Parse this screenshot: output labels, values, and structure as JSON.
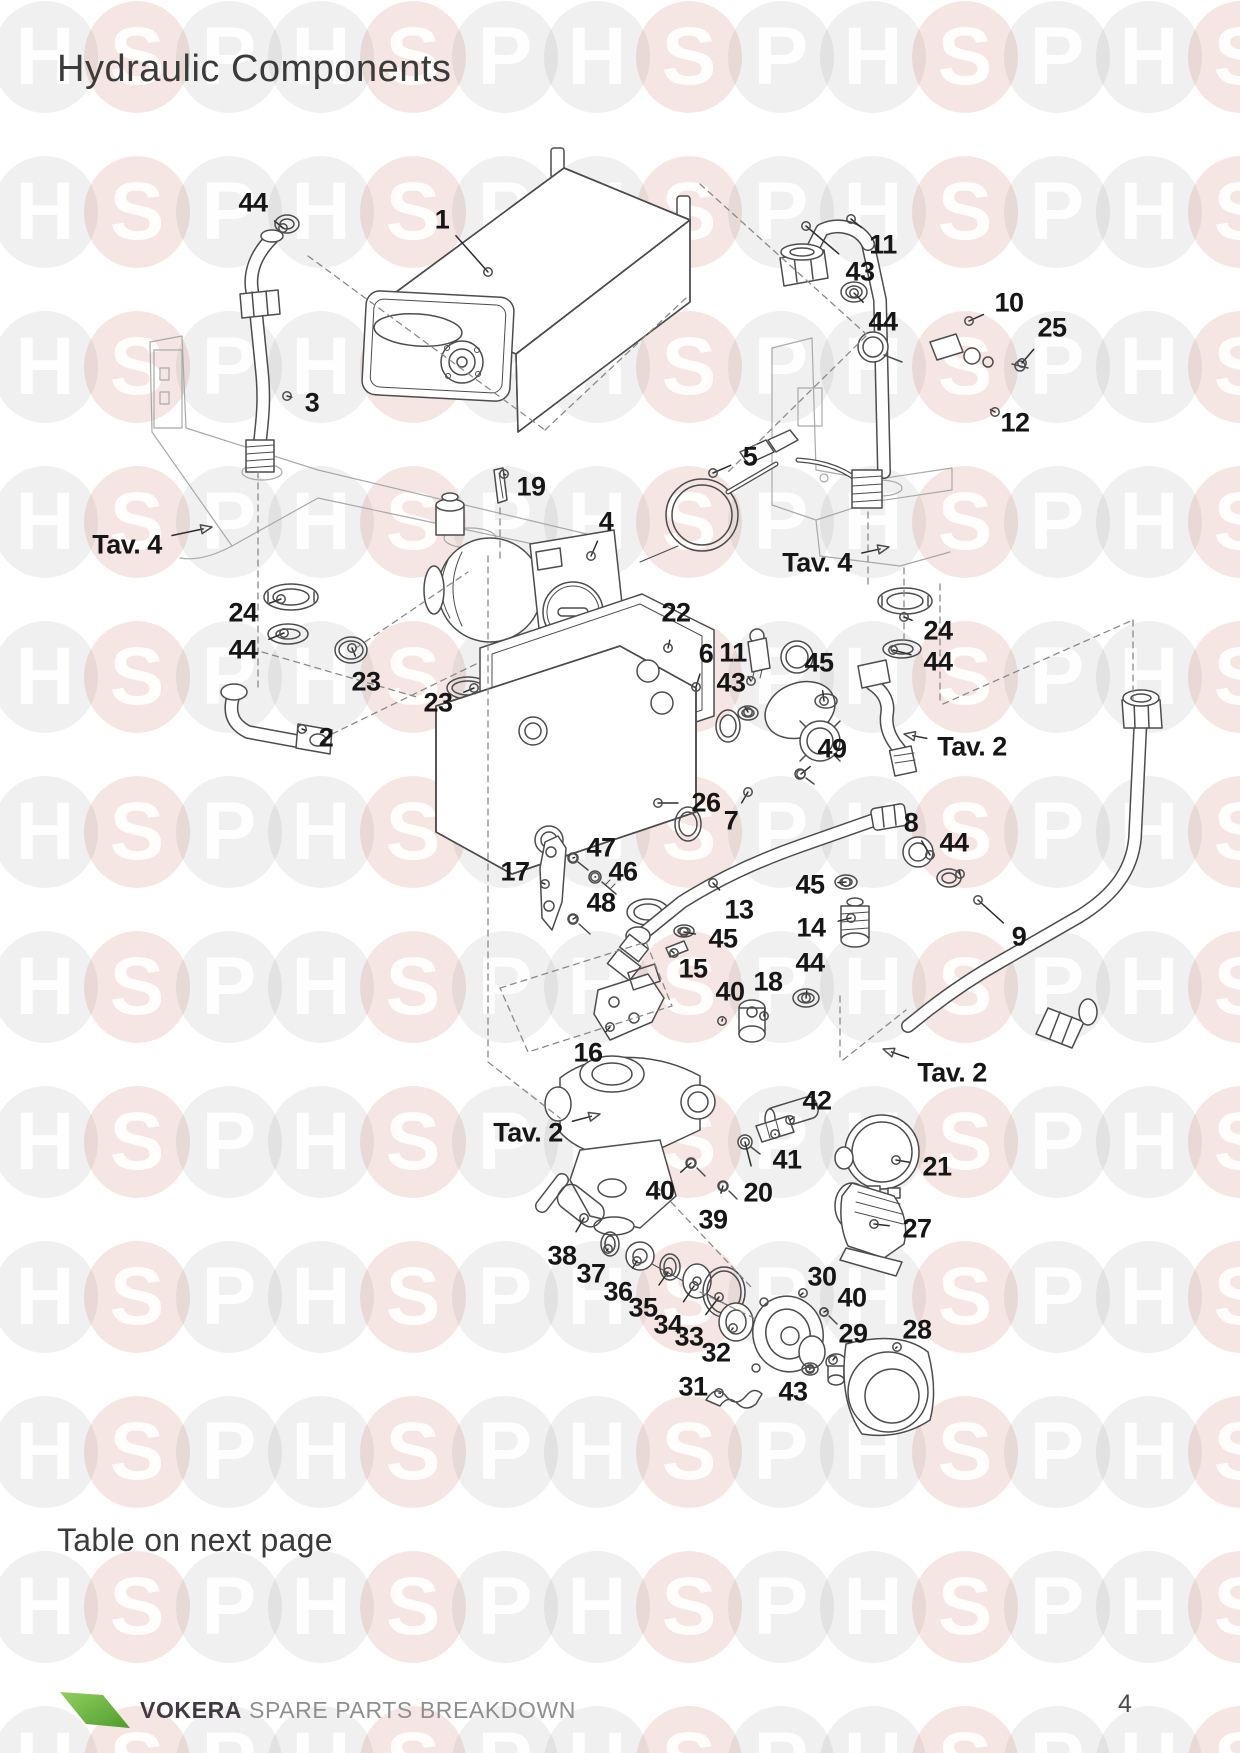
{
  "page": {
    "title": "Hydraulic Components",
    "note": "Table on next page",
    "page_number": "4",
    "footer": {
      "brand": "VOKERA",
      "tagline": "SPARE PARTS BREAKDOWN"
    }
  },
  "watermark": {
    "letters": [
      "H",
      "S",
      "P"
    ],
    "pink_rgba": "rgba(185,62,42,0.13)",
    "gray_rgba": "rgba(60,60,60,0.08)",
    "letter_color": "rgba(255,255,255,0.93)",
    "cols": 14,
    "rows": 12,
    "x0": 45,
    "y0": 57,
    "dx": 92,
    "dy": 155
  },
  "colors": {
    "ink": "#161616",
    "line": "#4c4c4c",
    "faint": "#a9a9a9",
    "logo_green": "#72bf44",
    "text": "#3b3b3b",
    "muted": "#8f8f92"
  },
  "diagram": {
    "callouts": [
      {
        "label": "44",
        "x": 253,
        "y": 203,
        "tx": 283,
        "ty": 228
      },
      {
        "label": "1",
        "x": 442,
        "y": 220,
        "tx": 488,
        "ty": 272
      },
      {
        "label": "3",
        "x": 312,
        "y": 403,
        "tx": 287,
        "ty": 396
      },
      {
        "label": "19",
        "x": 531,
        "y": 487,
        "tx": 504,
        "ty": 474
      },
      {
        "label": "4",
        "x": 606,
        "y": 522,
        "tx": 591,
        "ty": 556
      },
      {
        "label": "Tav. 4",
        "x": 127,
        "y": 545,
        "tx": 212,
        "ty": 527,
        "kind": "ref"
      },
      {
        "label": "24",
        "x": 243,
        "y": 613,
        "tx": 281,
        "ty": 599
      },
      {
        "label": "44",
        "x": 243,
        "y": 650,
        "tx": 284,
        "ty": 633
      },
      {
        "label": "23",
        "x": 366,
        "y": 682,
        "tx": 352,
        "ty": 648
      },
      {
        "label": "23",
        "x": 438,
        "y": 703,
        "tx": 474,
        "ty": 688
      },
      {
        "label": "2",
        "x": 326,
        "y": 738,
        "tx": 302,
        "ty": 729
      },
      {
        "label": "11",
        "x": 883,
        "y": 245,
        "tx": 851,
        "ty": 219
      },
      {
        "label": "43",
        "x": 860,
        "y": 272,
        "tx": 806,
        "ty": 226
      },
      {
        "label": "44",
        "x": 883,
        "y": 322,
        "tx": 854,
        "ty": 293
      },
      {
        "label": "10",
        "x": 1009,
        "y": 303,
        "tx": 969,
        "ty": 321
      },
      {
        "label": "25",
        "x": 1052,
        "y": 328,
        "tx": 1022,
        "ty": 363
      },
      {
        "label": "12",
        "x": 1015,
        "y": 423,
        "tx": 995,
        "ty": 412
      },
      {
        "label": "5",
        "x": 750,
        "y": 457,
        "tx": 713,
        "ty": 473
      },
      {
        "label": "Tav. 4",
        "x": 817,
        "y": 563,
        "tx": 889,
        "ty": 547,
        "kind": "ref"
      },
      {
        "label": "22",
        "x": 676,
        "y": 613,
        "tx": 668,
        "ty": 648
      },
      {
        "label": "6",
        "x": 706,
        "y": 654,
        "tx": 696,
        "ty": 687
      },
      {
        "label": "11",
        "x": 733,
        "y": 653,
        "tx": 751,
        "ty": 681
      },
      {
        "label": "43",
        "x": 731,
        "y": 683,
        "tx": 748,
        "ty": 712
      },
      {
        "label": "45",
        "x": 819,
        "y": 663,
        "tx": 824,
        "ty": 701
      },
      {
        "label": "24",
        "x": 938,
        "y": 631,
        "tx": 904,
        "ty": 617
      },
      {
        "label": "44",
        "x": 938,
        "y": 662,
        "tx": 893,
        "ty": 650
      },
      {
        "label": "49",
        "x": 832,
        "y": 749,
        "tx": 801,
        "ty": 774
      },
      {
        "label": "Tav. 2",
        "x": 972,
        "y": 747,
        "tx": 904,
        "ty": 734,
        "kind": "ref"
      },
      {
        "label": "26",
        "x": 706,
        "y": 803,
        "tx": 658,
        "ty": 803
      },
      {
        "label": "7",
        "x": 731,
        "y": 821,
        "tx": 748,
        "ty": 792
      },
      {
        "label": "8",
        "x": 911,
        "y": 823,
        "tx": 930,
        "ty": 855
      },
      {
        "label": "44",
        "x": 954,
        "y": 843,
        "tx": 960,
        "ty": 874
      },
      {
        "label": "45",
        "x": 810,
        "y": 885,
        "tx": 846,
        "ty": 882
      },
      {
        "label": "13",
        "x": 739,
        "y": 910,
        "tx": 713,
        "ty": 883
      },
      {
        "label": "14",
        "x": 811,
        "y": 928,
        "tx": 851,
        "ty": 918
      },
      {
        "label": "9",
        "x": 1019,
        "y": 937,
        "tx": 978,
        "ty": 900
      },
      {
        "label": "45",
        "x": 723,
        "y": 939,
        "tx": 684,
        "ty": 932
      },
      {
        "label": "44",
        "x": 810,
        "y": 963,
        "tx": 806,
        "ty": 998
      },
      {
        "label": "15",
        "x": 693,
        "y": 969,
        "tx": 674,
        "ty": 953
      },
      {
        "label": "47",
        "x": 601,
        "y": 848,
        "tx": 573,
        "ty": 858
      },
      {
        "label": "46",
        "x": 623,
        "y": 872,
        "tx": 595,
        "ty": 877
      },
      {
        "label": "17",
        "x": 515,
        "y": 872,
        "tx": 545,
        "ty": 884
      },
      {
        "label": "48",
        "x": 601,
        "y": 903,
        "tx": 573,
        "ty": 919
      },
      {
        "label": "18",
        "x": 768,
        "y": 982,
        "tx": 764,
        "ty": 1016
      },
      {
        "label": "40",
        "x": 730,
        "y": 992,
        "tx": 722,
        "ty": 1021
      },
      {
        "label": "16",
        "x": 588,
        "y": 1053,
        "tx": 610,
        "ty": 1027
      },
      {
        "label": "Tav. 2",
        "x": 952,
        "y": 1073,
        "tx": 883,
        "ty": 1049,
        "kind": "ref"
      },
      {
        "label": "Tav. 2",
        "x": 528,
        "y": 1133,
        "tx": 600,
        "ty": 1114,
        "kind": "ref"
      },
      {
        "label": "42",
        "x": 817,
        "y": 1101,
        "tx": 790,
        "ty": 1120
      },
      {
        "label": "41",
        "x": 787,
        "y": 1160,
        "tx": 775,
        "ty": 1134
      },
      {
        "label": "20",
        "x": 758,
        "y": 1193,
        "tx": 745,
        "ty": 1142
      },
      {
        "label": "40",
        "x": 660,
        "y": 1191,
        "tx": 691,
        "ty": 1163
      },
      {
        "label": "39",
        "x": 713,
        "y": 1220,
        "tx": 723,
        "ty": 1186
      },
      {
        "label": "21",
        "x": 937,
        "y": 1167,
        "tx": 896,
        "ty": 1160
      },
      {
        "label": "27",
        "x": 917,
        "y": 1229,
        "tx": 874,
        "ty": 1224
      },
      {
        "label": "38",
        "x": 562,
        "y": 1256,
        "tx": 584,
        "ty": 1218
      },
      {
        "label": "37",
        "x": 591,
        "y": 1274,
        "tx": 608,
        "ty": 1249
      },
      {
        "label": "36",
        "x": 618,
        "y": 1292,
        "tx": 637,
        "ty": 1261
      },
      {
        "label": "35",
        "x": 643,
        "y": 1308,
        "tx": 668,
        "ty": 1272
      },
      {
        "label": "34",
        "x": 668,
        "y": 1325,
        "tx": 694,
        "ty": 1286
      },
      {
        "label": "33",
        "x": 689,
        "y": 1337,
        "tx": 719,
        "ty": 1297
      },
      {
        "label": "32",
        "x": 716,
        "y": 1353,
        "tx": 733,
        "ty": 1328
      },
      {
        "label": "31",
        "x": 693,
        "y": 1387,
        "tx": 719,
        "ty": 1393
      },
      {
        "label": "30",
        "x": 822,
        "y": 1277,
        "tx": 803,
        "ty": 1293
      },
      {
        "label": "40",
        "x": 852,
        "y": 1298,
        "tx": 824,
        "ty": 1312
      },
      {
        "label": "29",
        "x": 853,
        "y": 1334,
        "tx": 833,
        "ty": 1360
      },
      {
        "label": "43",
        "x": 793,
        "y": 1392,
        "tx": 810,
        "ty": 1369
      },
      {
        "label": "28",
        "x": 917,
        "y": 1330,
        "tx": 897,
        "ty": 1347
      }
    ]
  }
}
